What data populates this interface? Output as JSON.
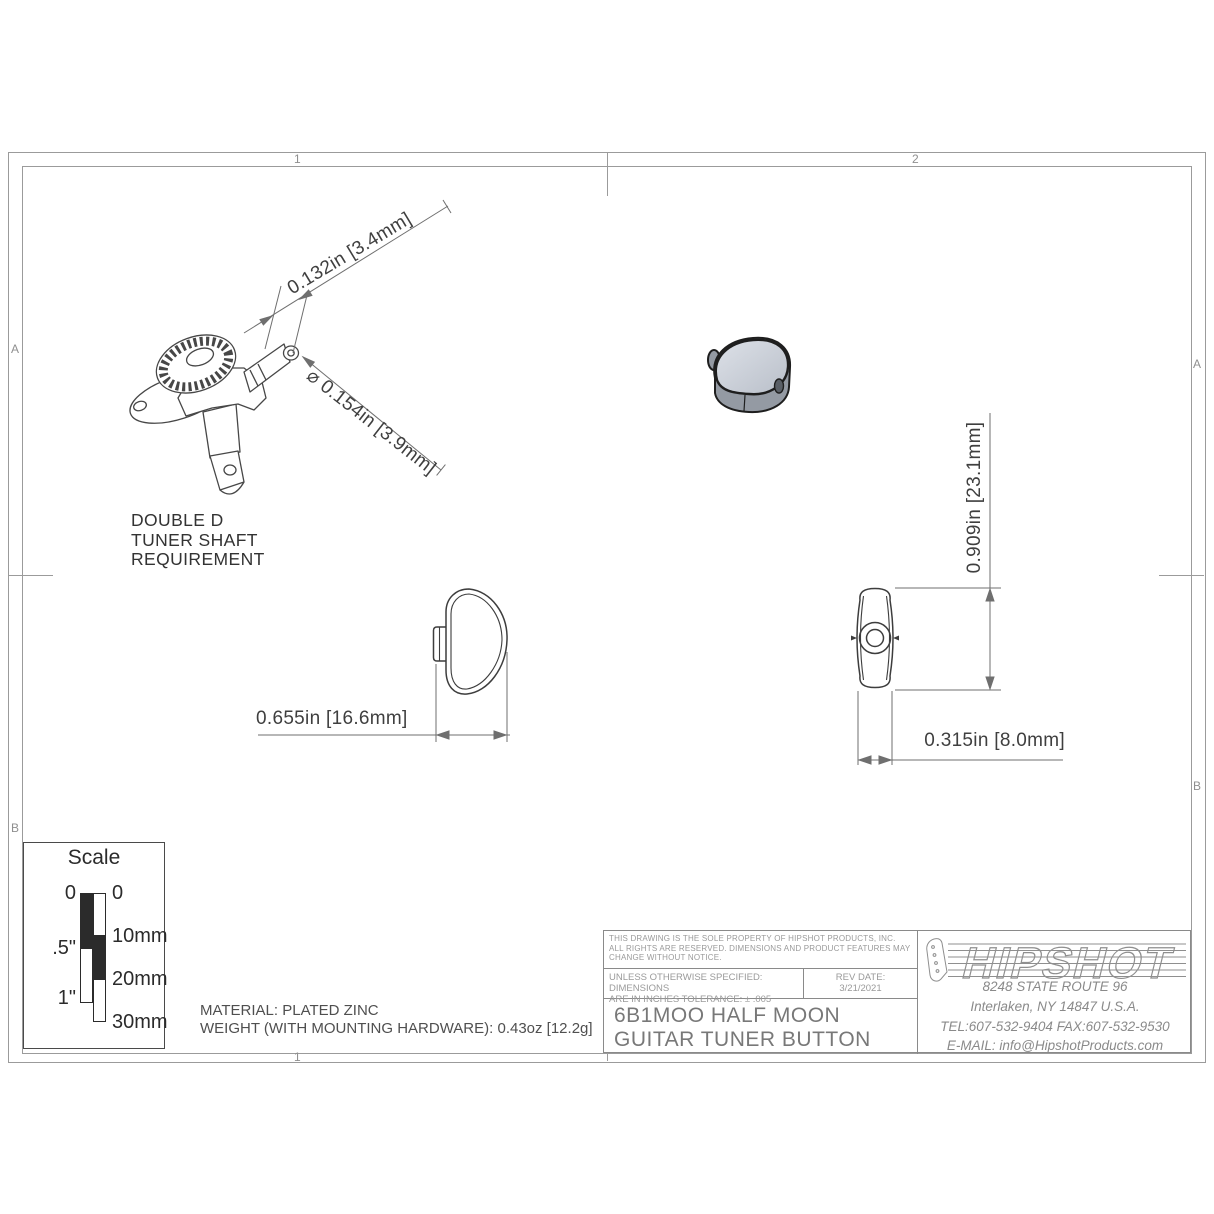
{
  "sheet": {
    "zones": {
      "top_left": "1",
      "top_right": "2",
      "bottom_left": "1",
      "left_upper": "A",
      "left_lower": "B",
      "right_upper": "A",
      "right_lower": "B"
    }
  },
  "dimensions": {
    "shaft_flat_width": "0.132in [3.4mm]",
    "shaft_diameter": "⌀ 0.154in [3.9mm]",
    "button_length": "0.655in [16.6mm]",
    "button_height": "0.909in [23.1mm]",
    "button_thickness": "0.315in [8.0mm]"
  },
  "notes": {
    "shaft_requirement_line1": "DOUBLE D",
    "shaft_requirement_line2": "TUNER SHAFT",
    "shaft_requirement_line3": "REQUIREMENT",
    "material": "MATERIAL: PLATED ZINC",
    "weight": "WEIGHT (WITH MOUNTING HARDWARE): 0.43oz [12.2g]"
  },
  "scale_box": {
    "title": "Scale",
    "inch_zero": "0",
    "inch_half": ".5\"",
    "inch_one": "1\"",
    "mm_zero": "0",
    "mm_ten": "10mm",
    "mm_twenty": "20mm",
    "mm_thirty": "30mm"
  },
  "title_block": {
    "legal": "THIS DRAWING IS THE SOLE PROPERTY OF HIPSHOT PRODUCTS, INC. ALL RIGHTS ARE RESERVED. DIMENSIONS AND PRODUCT FEATURES MAY CHANGE WITHOUT NOTICE.",
    "tolerance_line1": "UNLESS OTHERWISE SPECIFIED: DIMENSIONS",
    "tolerance_line2": "ARE IN INCHES TOLERANCE:  ± .005",
    "rev_date_label": "REV DATE:",
    "rev_date_value": "3/21/2021",
    "part_title_line1": "6B1MOO HALF MOON",
    "part_title_line2": "GUITAR TUNER BUTTON",
    "company": "HIPSHOT",
    "address_street": "8248 STATE ROUTE 96",
    "address_city": "Interlaken, NY 14847 U.S.A.",
    "address_phone": "TEL:607-532-9404 FAX:607-532-9530",
    "address_email": "E-MAIL: info@HipshotProducts.com"
  },
  "colors": {
    "frame_line": "#9b9b9b",
    "dim_line": "#6f6f6f",
    "view_line": "#3d3d3d",
    "button_top": "#d3d7df",
    "button_side": "#949aa3",
    "button_outline": "#1e1e1e"
  }
}
